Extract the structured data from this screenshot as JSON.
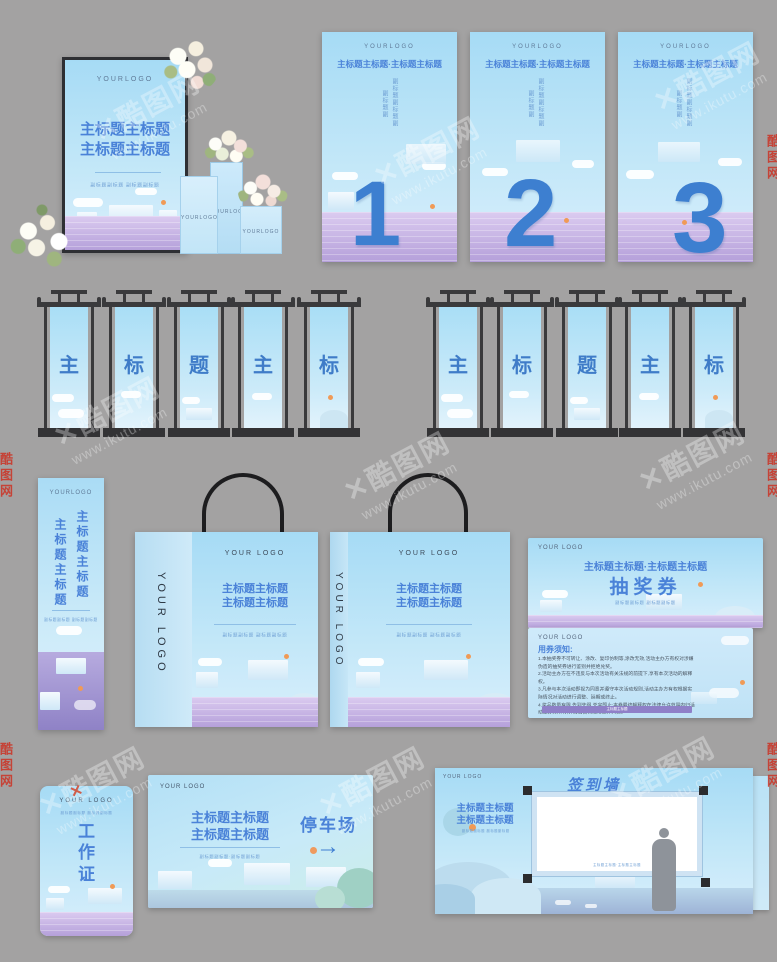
{
  "watermark": {
    "site_name": "酷图网",
    "url": "www.ikutu.com",
    "logo_glyph": "✕"
  },
  "backdrop": {
    "logo": "YOURLOGO",
    "title_line1": "主标题主标题",
    "title_line2": "主标题主标题",
    "subtitle": "副标题副标题  副标题副标题",
    "pedestal_logo": "YOURLOGO"
  },
  "posters": {
    "logo": "YOURLOGO",
    "headline": "主标题主标题·主标题主标题",
    "vertical_col1": "副标题副标题副",
    "vertical_col2": "副标题副",
    "numbers": [
      "1",
      "2",
      "3"
    ]
  },
  "hanging_banners": {
    "left_chars": [
      "主",
      "标",
      "题",
      "主",
      "标"
    ],
    "right_chars": [
      "主",
      "标",
      "题",
      "主",
      "标"
    ]
  },
  "xbanner": {
    "logo": "YOURLOGO",
    "col1": "主标题主标题",
    "col2": "主标题主标题",
    "subtitle": "副标题副标题 副标题副标题"
  },
  "bags": {
    "side_logo": "YOUR LOGO",
    "logo": "YOUR LOGO",
    "title_line1": "主标题主标题",
    "title_line2": "主标题主标题",
    "subtitle": "副标题副标题  副标题副标题"
  },
  "ticket": {
    "front": {
      "logo": "YOUR LOGO",
      "headline": "主标题主标题·主标题主标题",
      "title": "抽奖券",
      "subtitle": "副标题副标题  副标题副标题"
    },
    "back": {
      "logo": "YOUR LOGO",
      "notice_title": "用券须知:",
      "terms": [
        "1.本抽奖券不可转让、涂改、复印仿制等,涂改无效,活动主办方有权对涉嫌伪造的抽奖券进行鉴别并拒绝兑奖。",
        "2.活动主办方在不违反与本次活动有关法规的前提下,享有本次活动的解释权。",
        "3.凡参与本次活动即视为同意并遵守本次活动规则,活动主办方有权根据实际情况对活动进行调整、延期或终止。",
        "4.奖品数量有限,先到先得,兑完即止;本券最终解释权在法律允许范围内归活动主办方所有,详情请咨询现场工作人员。"
      ],
      "footer": "主标题主标题"
    }
  },
  "badge": {
    "logo": "YOUR LOGO",
    "subtitle": "副标题副标题 副标题副标题",
    "chars": [
      "工",
      "作",
      "证"
    ]
  },
  "parking": {
    "logo": "YOUR LOGO",
    "title_line1": "主标题主标题",
    "title_line2": "主标题主标题",
    "subtitle": "副标题副标题·副标题副标题",
    "sign_text": "停车场",
    "arrow": "→"
  },
  "signwall": {
    "logo": "YOUR LOGO",
    "wall_title": "签到墙",
    "title_line1": "主标题主标题",
    "title_line2": "主标题主标题",
    "subtitle": "副标题副标题  副标题副标题",
    "canvas_caption": "主标题主标题·主标题主标题"
  }
}
